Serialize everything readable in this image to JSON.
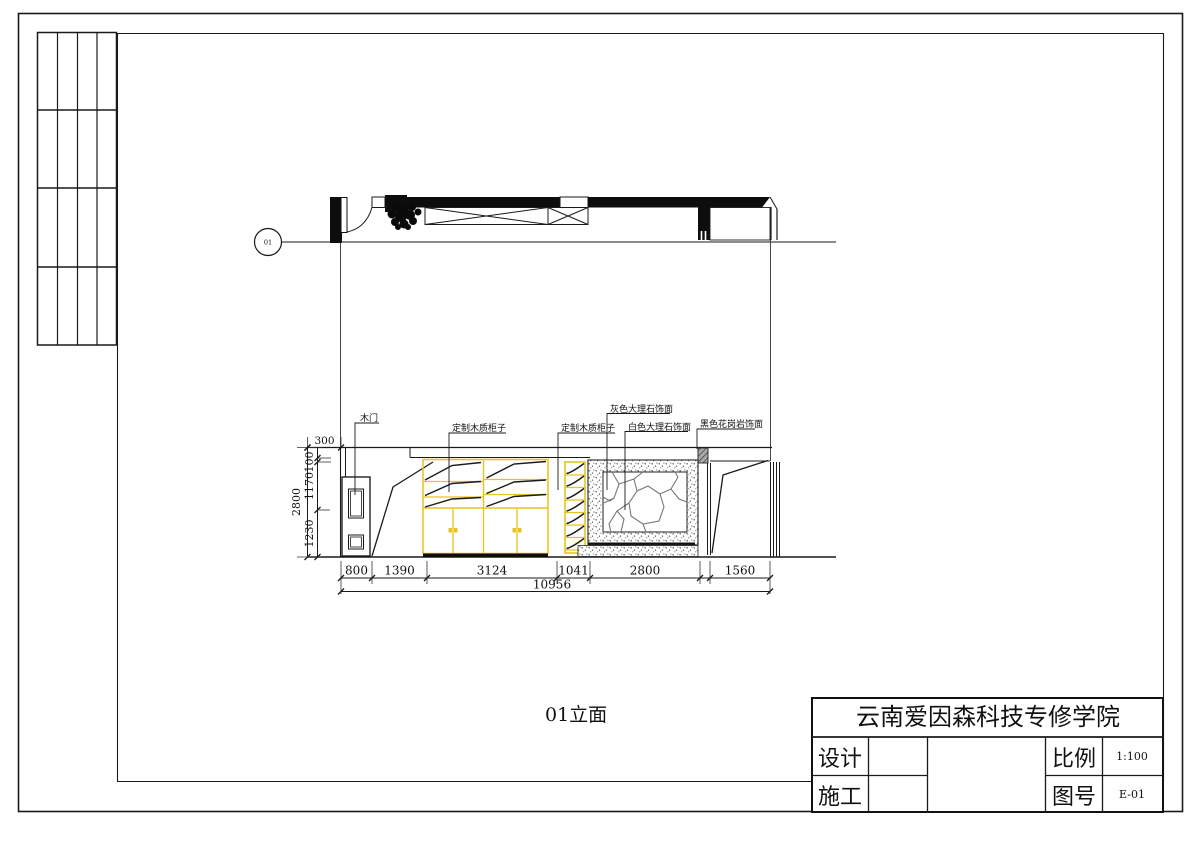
{
  "plan": {
    "marker": "01"
  },
  "callouts": {
    "wood_door": "木门",
    "custom_cabinet_1": "定制木质柜子",
    "custom_cabinet_2": "定制木质柜子",
    "gray_marble": "灰色大理石饰面",
    "white_marble": "白色大理石饰面",
    "black_granite": "黑色花岗岩饰面"
  },
  "dimensions": {
    "top_offset": "300",
    "h": [
      "800",
      "1390",
      "3124",
      "1041",
      "2800",
      "1560"
    ],
    "h_total": "10956",
    "v": [
      "100",
      "1170",
      "1230"
    ],
    "v_total": "2800"
  },
  "caption": "01立面",
  "title_block": {
    "company": "云南爱因森科技专修学院",
    "design_label": "设计",
    "construction_label": "施工",
    "scale_label": "比例",
    "scale_value": "1:100",
    "drawing_no_label": "图号",
    "drawing_no_value": "E-01"
  },
  "colors": {
    "cabinet_yellow": "#e8c31e",
    "line_dark": "#1a1a1a"
  }
}
